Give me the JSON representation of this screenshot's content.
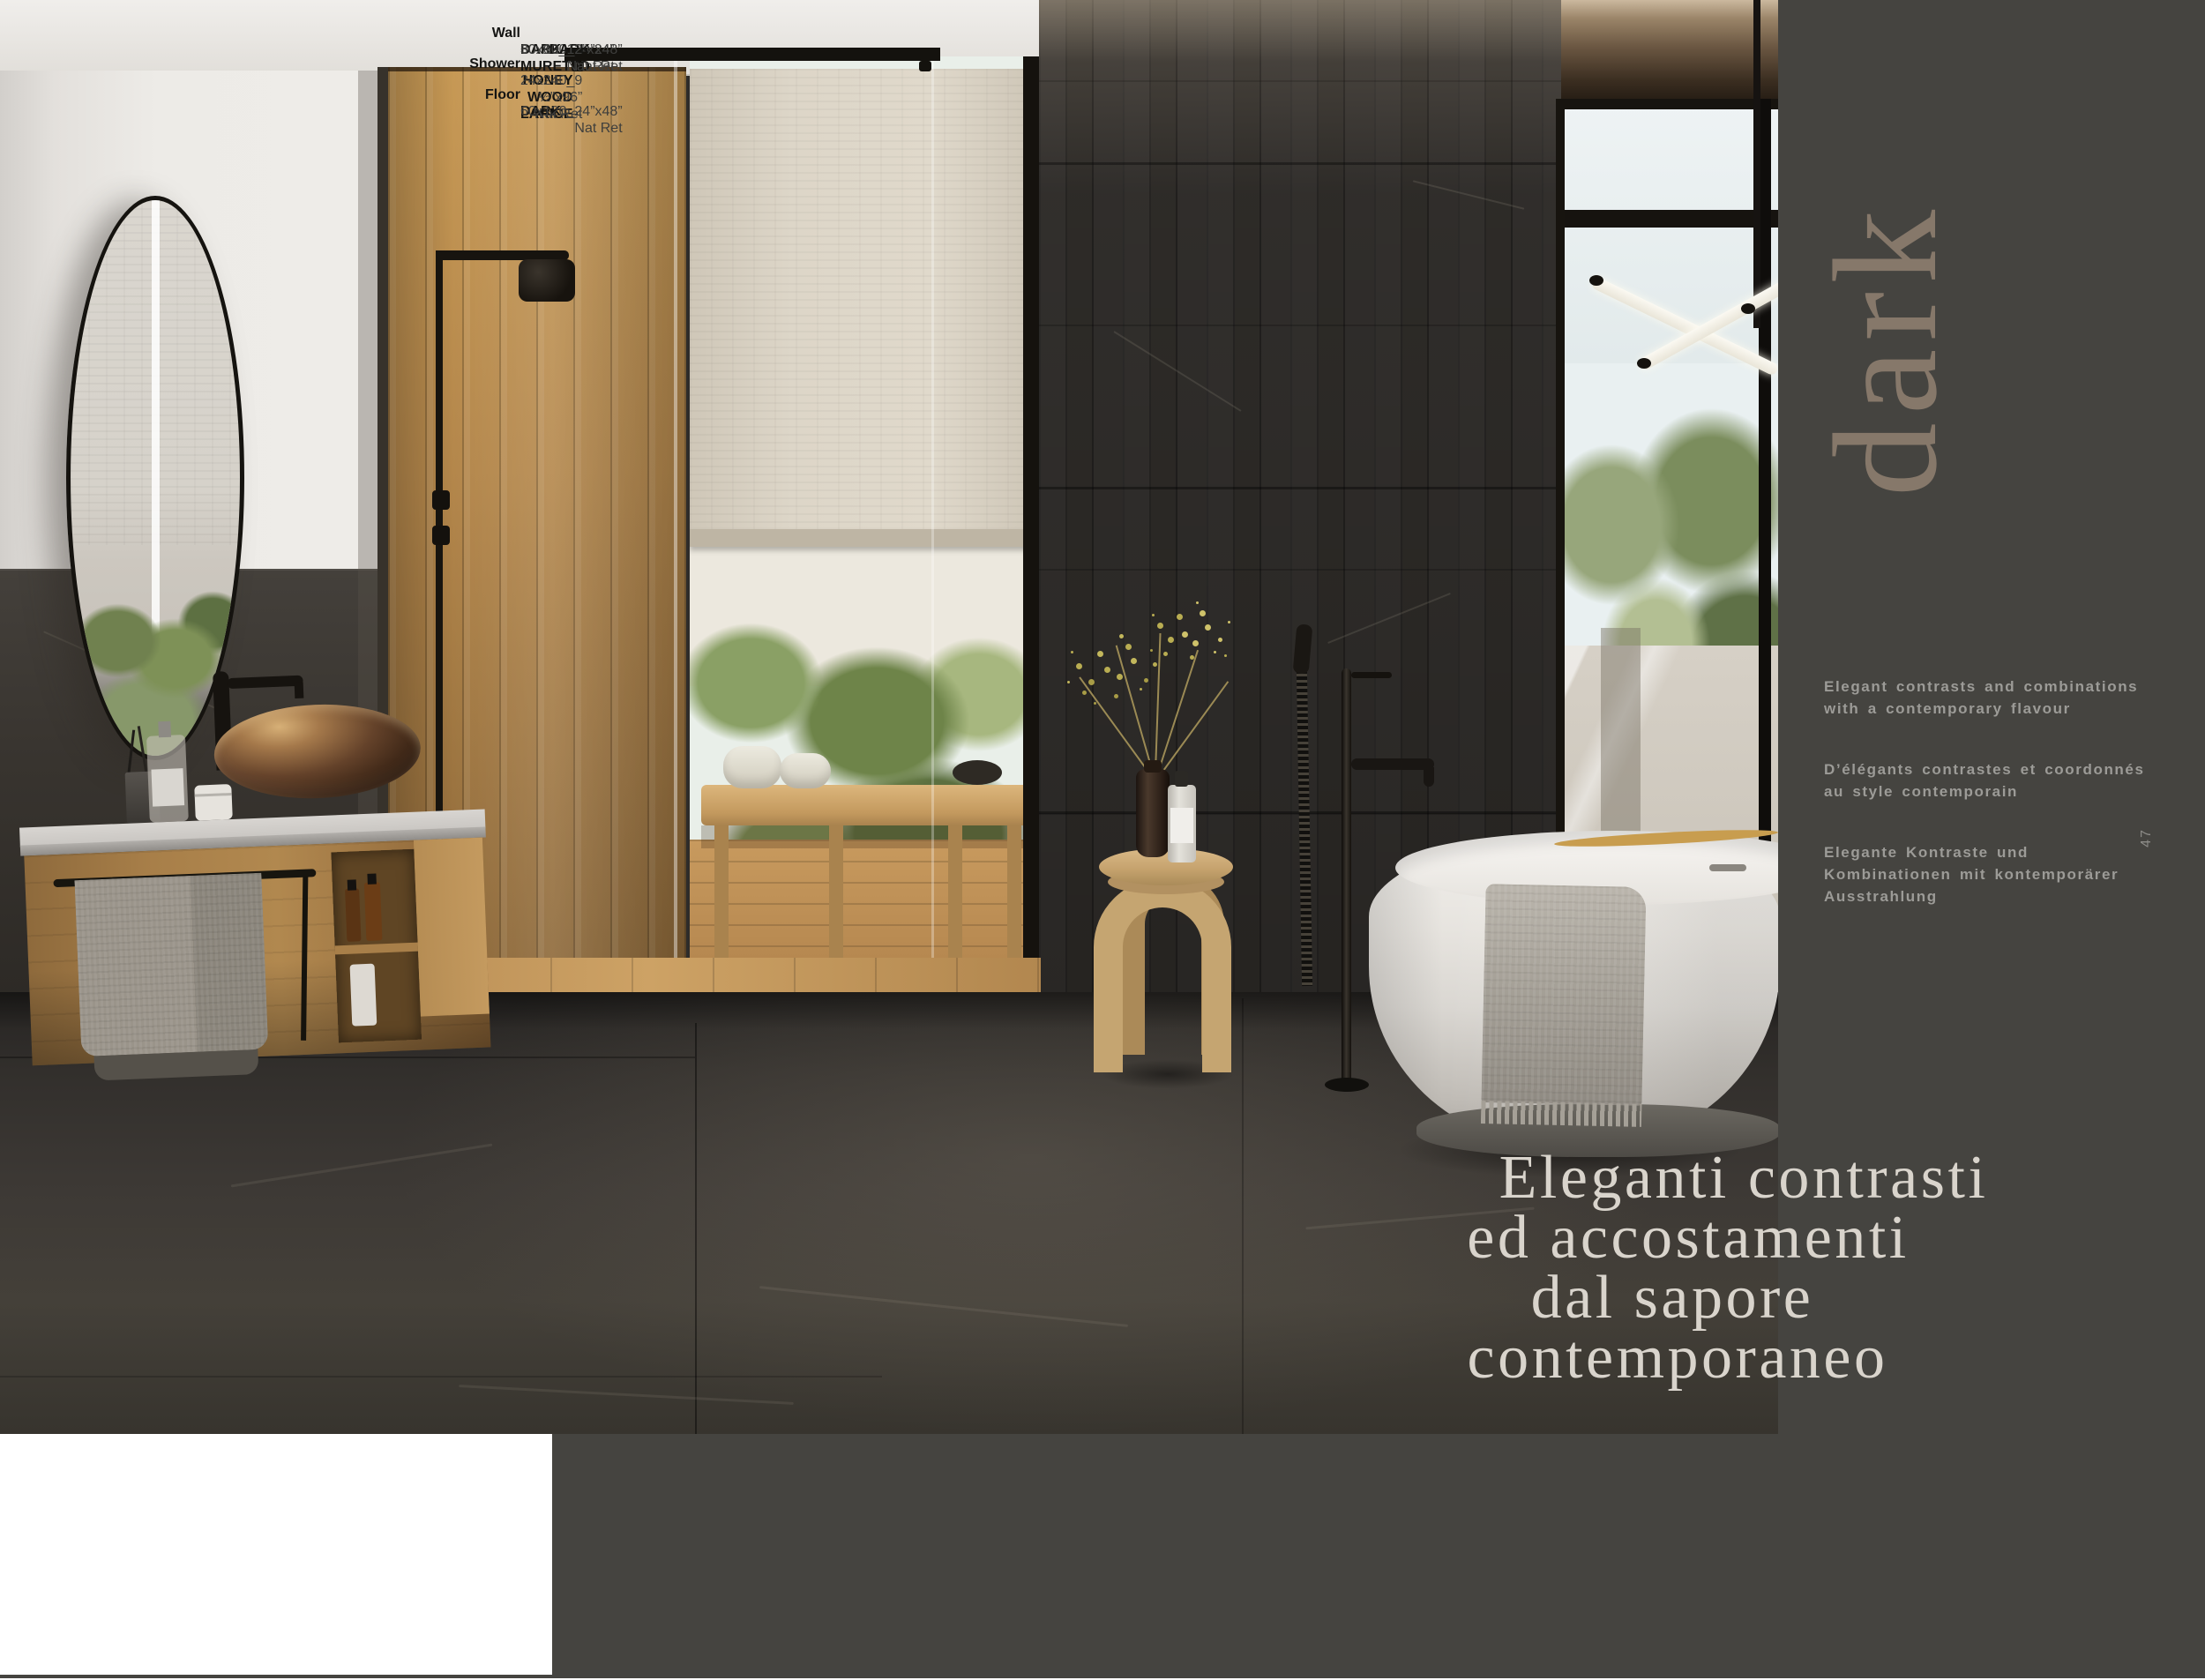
{
  "page": {
    "number": "47",
    "background": "#ffffff"
  },
  "sidebar": {
    "background": "#454440",
    "collection_title": "dark",
    "collection_title_color": "#86786a",
    "text_color": "#9c9b97",
    "descriptions": [
      {
        "lang": "en",
        "text": "Elegant contrasts and combinations with a contemporary flavour"
      },
      {
        "lang": "fr",
        "text": "D’élégants contrastes et coordonnés au style contemporain"
      },
      {
        "lang": "de",
        "text": "Elegante Kontraste und Kombinationen mit kontemporärer Ausstrahlung"
      }
    ]
  },
  "quote": {
    "color": "#d9d4cc",
    "lines": [
      "Eleganti contrasti",
      "ed accostamenti",
      "dal sapore",
      "contemporaneo"
    ]
  },
  "specs": {
    "groups": [
      {
        "heading": "Wall",
        "lines": [
          {
            "product": "DARK",
            "detail": "60x120_24”x48” Nat Ret"
          },
          {
            "product": "DARK MURETTO",
            "detail": "30x60_12”x24” Nat Ret"
          }
        ]
      },
      {
        "heading": "Shower",
        "lines": [
          {
            "product": "HONEY WOOD LARICE",
            "detail": "24x240_9 ½”x96” Nat Ret"
          }
        ]
      },
      {
        "heading": "Floor",
        "lines": [
          {
            "product": "DARK",
            "detail": "60x120_24”x48” Nat Ret"
          }
        ]
      }
    ]
  }
}
